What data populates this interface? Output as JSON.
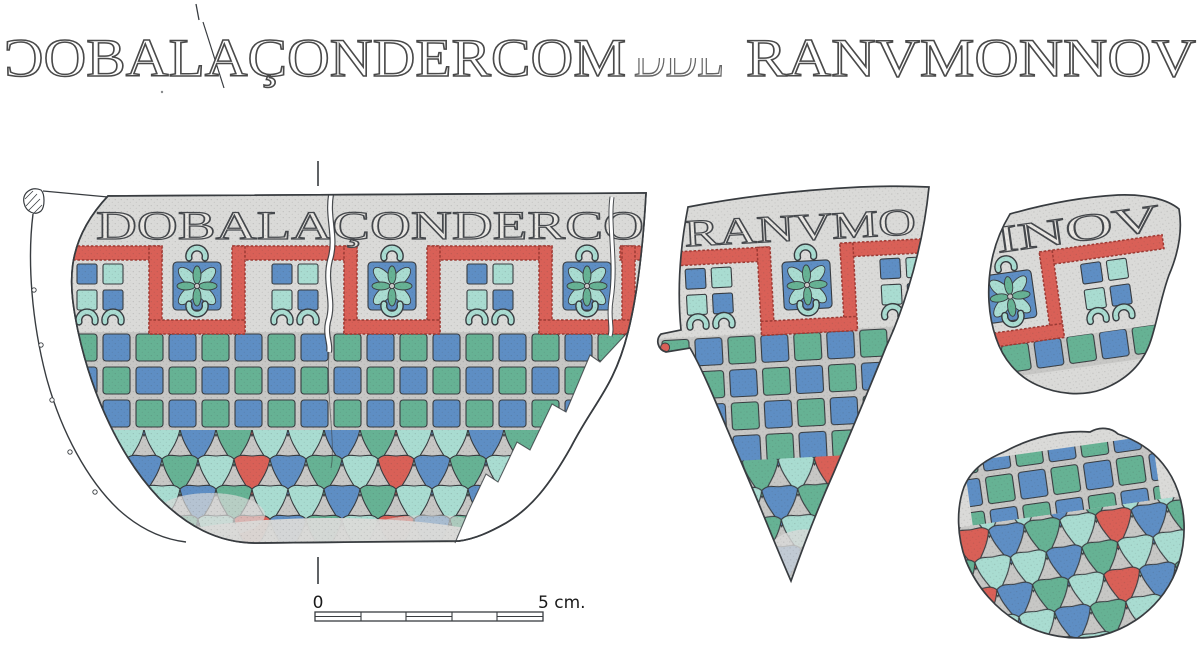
{
  "colors": {
    "ink": "#383c40",
    "metal": "#dadad8",
    "grout": "#c7c7c5",
    "paper": "#ffffff",
    "red": "#d96057",
    "redDeep": "#9e3a34",
    "blue": "#5e8ec4",
    "green": "#66b294",
    "aqua": "#a9dcd1"
  },
  "banner": {
    "part1": "ƆOBALAÇONDERCOM",
    "damaged": "DDL",
    "part2": "RANVMONNOV"
  },
  "vessel": {
    "band_text": "DOBALAÇONDERCO"
  },
  "fragment2": {
    "band_text": "RANVMO"
  },
  "fragment3": {
    "band_text": "INOV"
  },
  "scale_bar": {
    "start": "0",
    "end": "5 cm.",
    "segments": 5
  }
}
